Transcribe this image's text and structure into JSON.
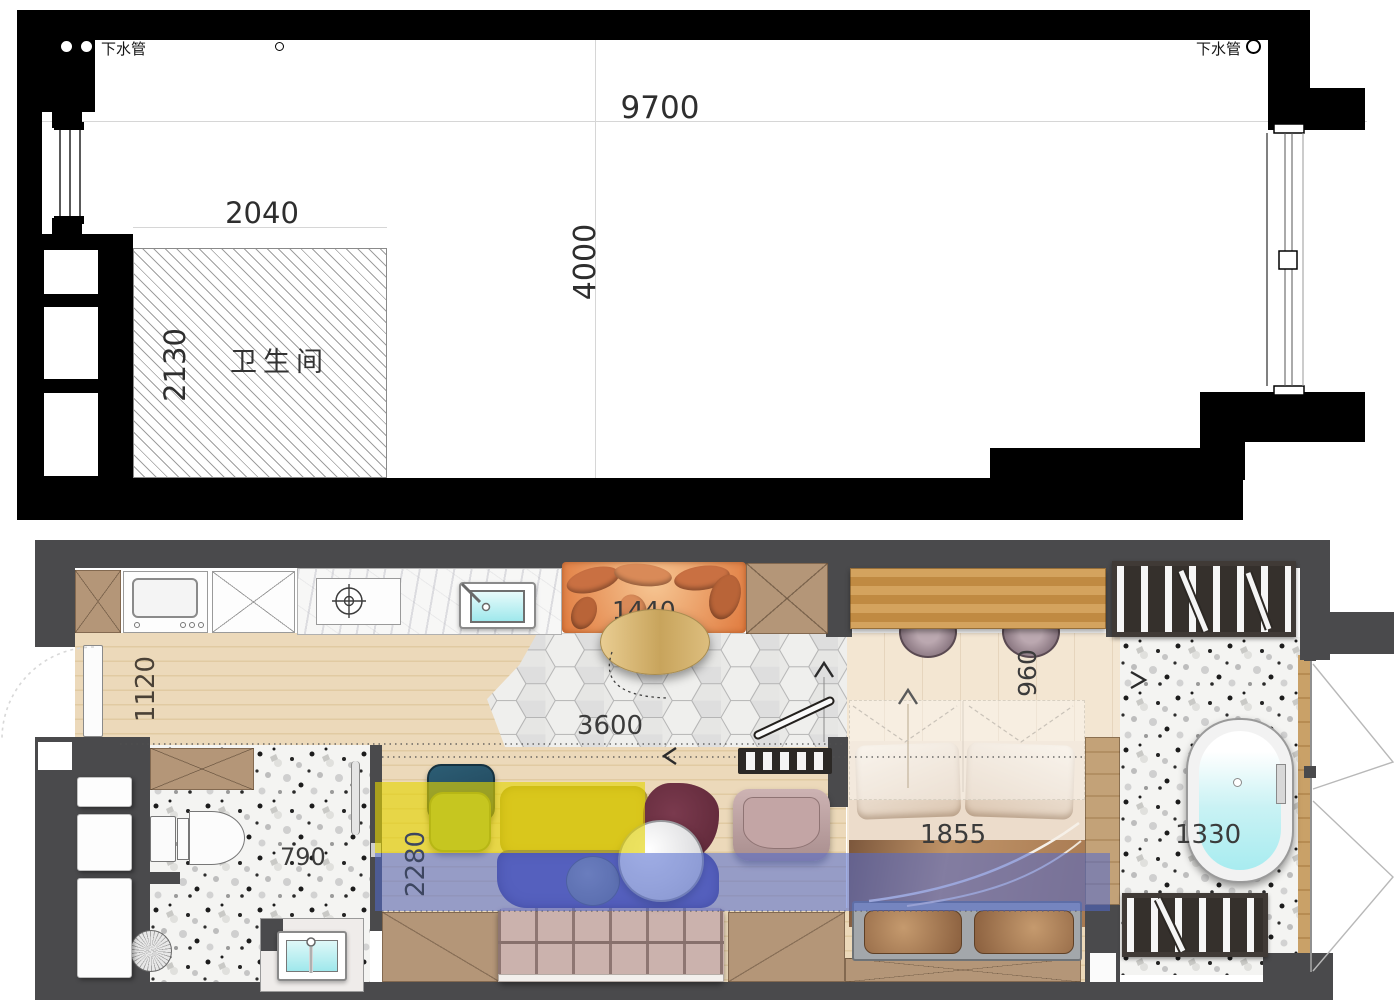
{
  "shell_plan": {
    "labels": {
      "drain_pipe_left": "下水管",
      "drain_pipe_right": "下水管",
      "bathroom_room": "卫生间"
    },
    "dims": {
      "overall_width": "9700",
      "overall_depth": "4000",
      "bathroom_width": "2040",
      "bathroom_depth": "2130"
    }
  },
  "furnished_plan": {
    "dims": {
      "entry_strip": "1120",
      "living_span": "3600",
      "banquette": "1440",
      "desk_nook": "960",
      "chaise_zone": "2280",
      "bathroom": "790",
      "bed": "1855",
      "bathtub": "1330"
    },
    "colors": {
      "wall": "#4a4a4c",
      "yellow_highlight": "#e8d412",
      "blue_highlight": "#5870d2",
      "water": "#aeeef2",
      "banquette_orange": "#d9854f",
      "wood_floor": "#ead9bc",
      "terrazzo": "#f3f3f1"
    }
  }
}
